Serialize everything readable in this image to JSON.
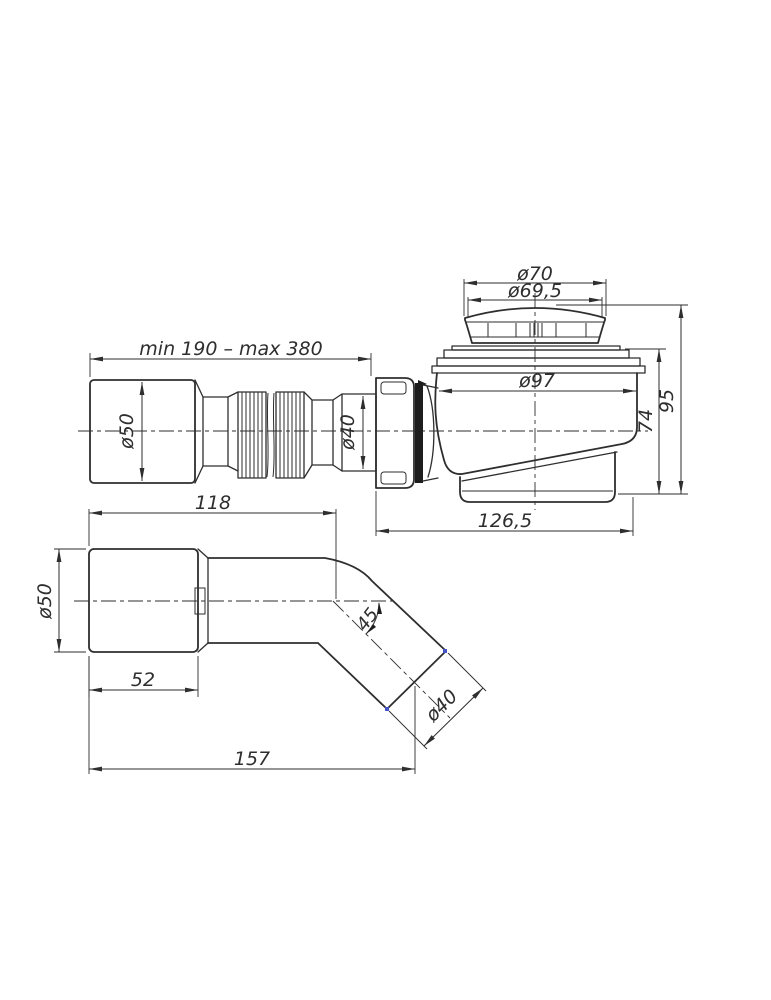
{
  "drawing": {
    "colors": {
      "ink": "#2e2e2e",
      "marker_blue": "#4553c8",
      "background": "#ffffff"
    },
    "side_view": {
      "flex_length": "min 190 – max 380",
      "cap_diameter": "ø70",
      "cap_inner_diameter": "ø69,5",
      "inlet_diameter": "ø50",
      "hose_diameter": "ø40",
      "body_diameter": "ø97",
      "body_height": "74",
      "total_height": "95",
      "body_length": "126,5"
    },
    "elbow_view": {
      "straight_length": "118",
      "socket_diameter": "ø50",
      "socket_length": "52",
      "bend_angle": "45",
      "outlet_diameter": "ø40",
      "total_length": "157"
    }
  }
}
